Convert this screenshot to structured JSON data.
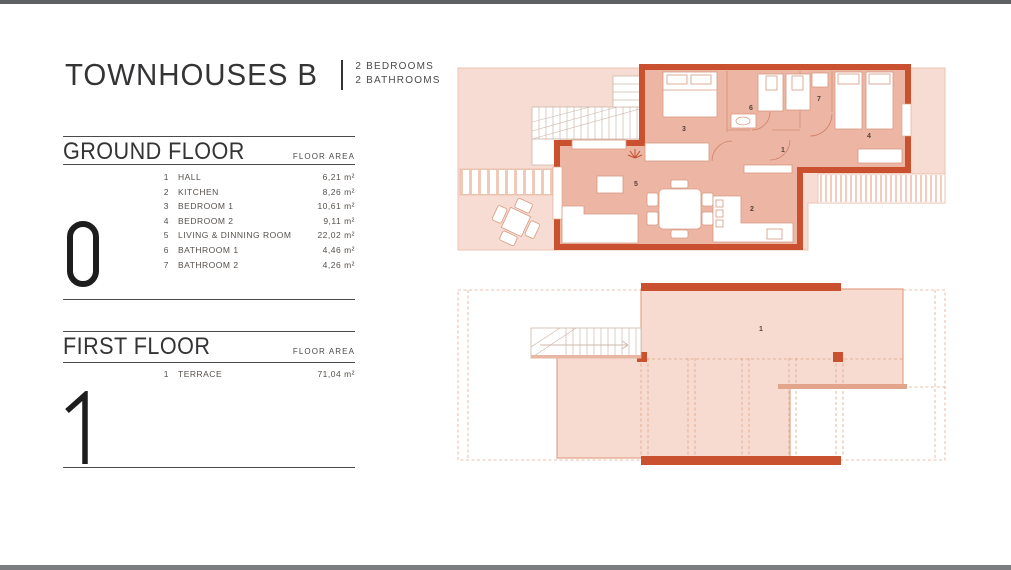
{
  "header": {
    "title": "TOWNHOUSES B",
    "separator": "|",
    "subtitle_line1": "2 BEDROOMS",
    "subtitle_line2": "2 BATHROOMS"
  },
  "ground_floor": {
    "heading": "GROUND FLOOR",
    "area_label": "FLOOR AREA",
    "level_numeral": "0",
    "rooms": [
      {
        "num": "1",
        "name": "HALL",
        "area": "6,21 m²"
      },
      {
        "num": "2",
        "name": "KITCHEN",
        "area": "8,26 m²"
      },
      {
        "num": "3",
        "name": "BEDROOM 1",
        "area": "10,61 m²"
      },
      {
        "num": "4",
        "name": "BEDROOM 2",
        "area": "9,11 m²"
      },
      {
        "num": "5",
        "name": "LIVING & DINNING ROOM",
        "area": "22,02 m²"
      },
      {
        "num": "6",
        "name": "BATHROOM 1",
        "area": "4,46 m²"
      },
      {
        "num": "7",
        "name": "BATHROOM 2",
        "area": "4,26 m²"
      }
    ]
  },
  "first_floor": {
    "heading": "FIRST FLOOR",
    "area_label": "FLOOR AREA",
    "level_numeral": "1",
    "rooms": [
      {
        "num": "1",
        "name": "TERRACE",
        "area": "71,04 m²"
      }
    ]
  },
  "plans": {
    "colors": {
      "wall_red": "#c9512f",
      "interior_floor": "#ecb5a4",
      "outdoor_light": "#f6dcd2",
      "terrace_fill": "#f7dbd0",
      "thin_outline": "#e2a58c",
      "furniture_outline": "#d89a82",
      "label_text": "#54423a"
    },
    "ground": {
      "numbers": {
        "hall": "1",
        "kitchen": "2",
        "bedroom1": "3",
        "bedroom2": "4",
        "living": "5",
        "bathroom1": "6",
        "bathroom2": "7"
      }
    },
    "first": {
      "numbers": {
        "terrace": "1"
      }
    }
  }
}
